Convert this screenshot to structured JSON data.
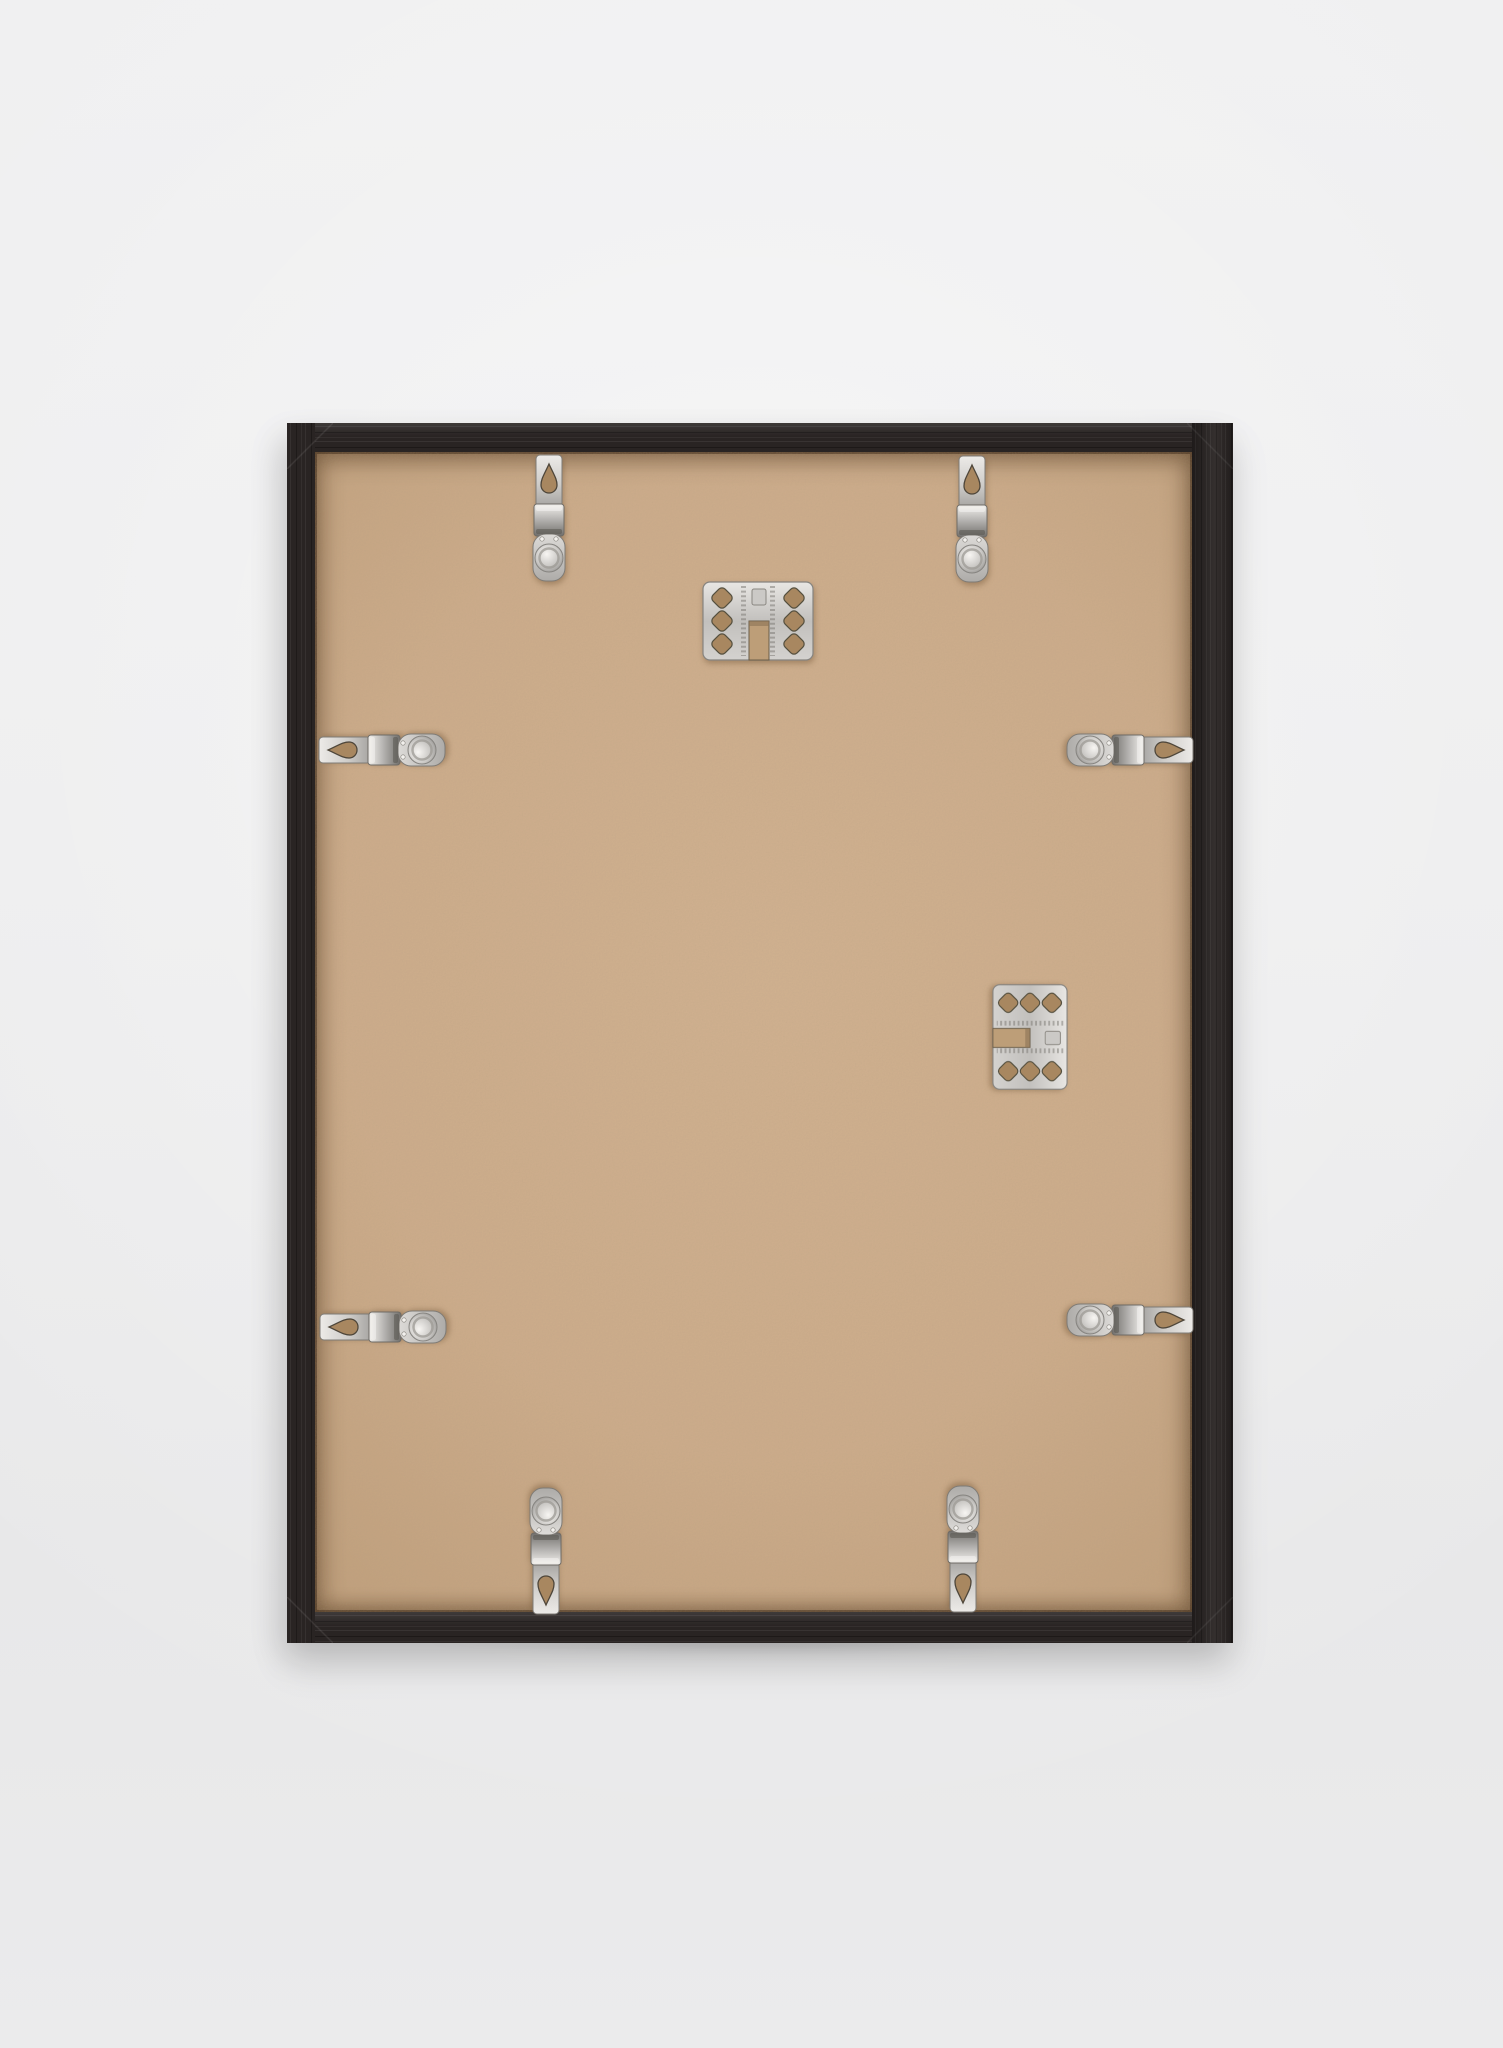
{
  "scene": {
    "alt": "Back view of a black wood picture frame leaning upright against a plain light-grey wall. A tan MDF backing board is held in place by eight shiny nickel spring clips spaced around the edges, each clip with a teardrop punch hole and a round embossed dome. Two punched nickel hanger plates are fixed to the board: one near the top centre with its slot opening downward, one at the middle right with its slot opening left.",
    "background_color": "#ececed",
    "frame_color": "#292423",
    "backing_color": "#cbab8a",
    "metal_color": "#d6d4d1",
    "hardware": {
      "spring_clip_count": 8,
      "hanger_plate_count": 2,
      "clips": [
        {
          "id": "spring-clip-top-left",
          "edge": "top"
        },
        {
          "id": "spring-clip-top-right",
          "edge": "top"
        },
        {
          "id": "spring-clip-left-upper",
          "edge": "left"
        },
        {
          "id": "spring-clip-left-lower",
          "edge": "left"
        },
        {
          "id": "spring-clip-right-upper",
          "edge": "right"
        },
        {
          "id": "spring-clip-right-lower",
          "edge": "right"
        },
        {
          "id": "spring-clip-bottom-left",
          "edge": "bottom"
        },
        {
          "id": "spring-clip-bottom-right",
          "edge": "bottom"
        }
      ],
      "plates": [
        {
          "id": "hanger-plate-top-center",
          "slot_direction": "down"
        },
        {
          "id": "hanger-plate-right-middle",
          "slot_direction": "left"
        }
      ]
    }
  }
}
